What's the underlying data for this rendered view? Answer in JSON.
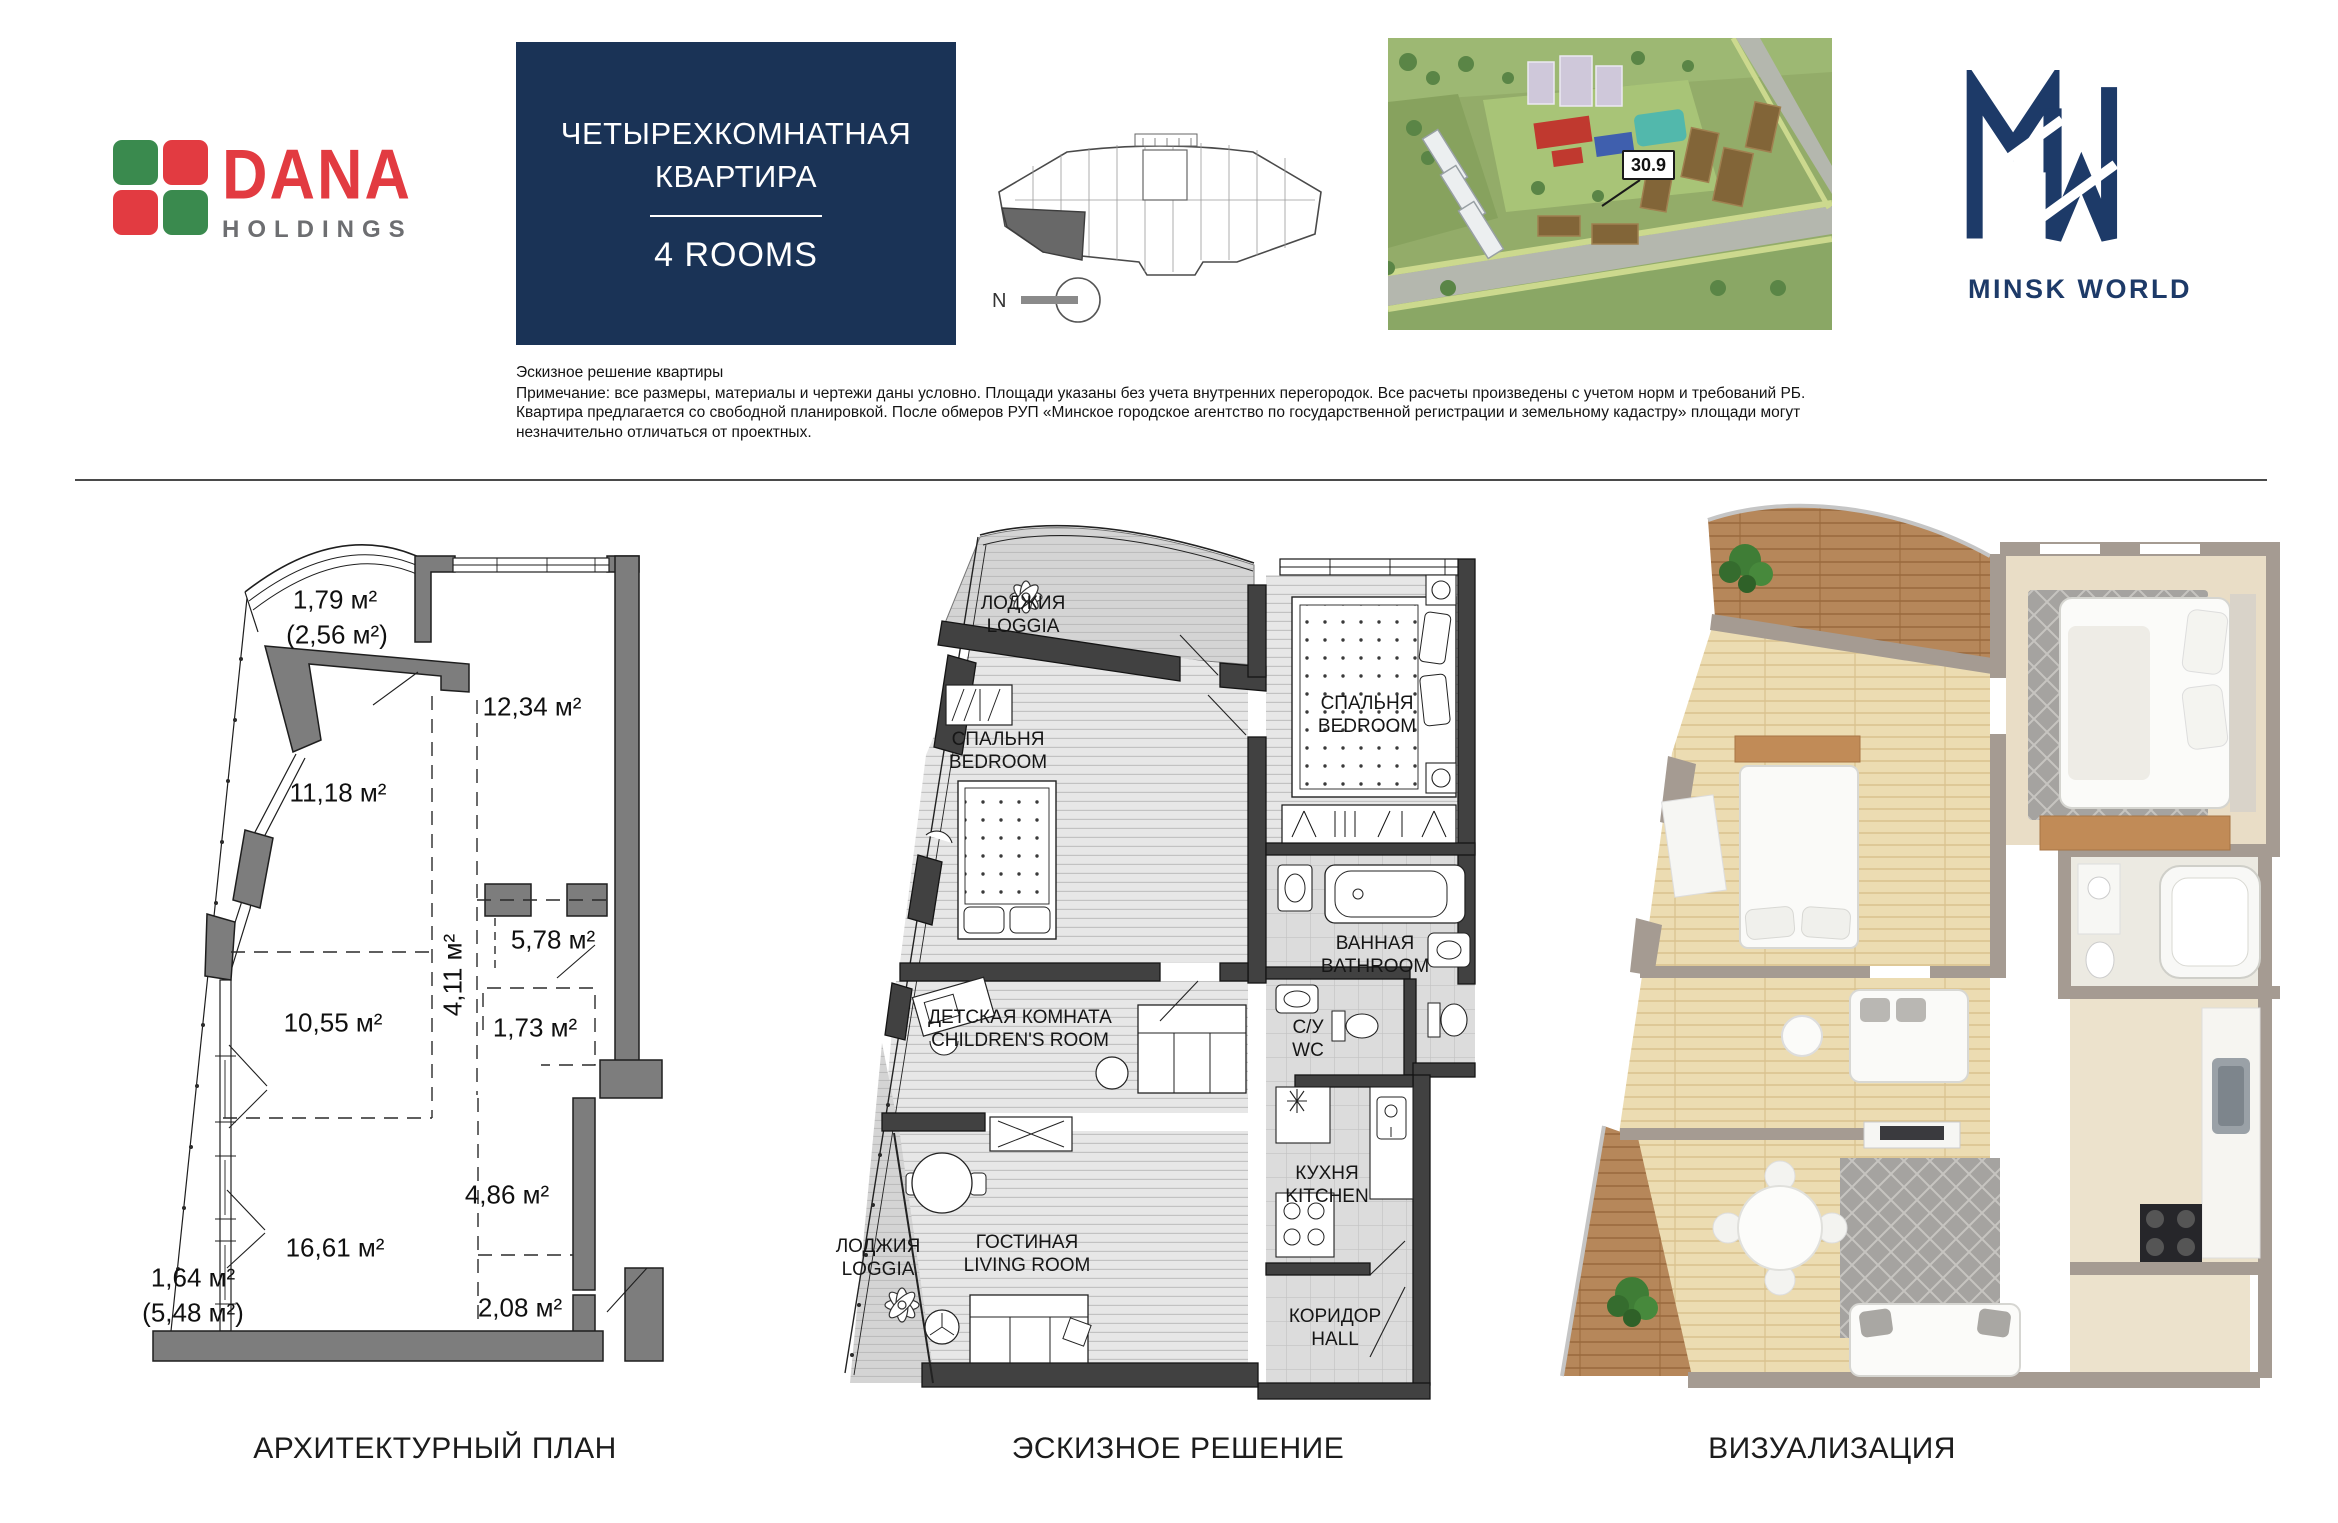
{
  "header": {
    "dana": {
      "name": "DANA",
      "subname": "HOLDINGS"
    },
    "title_block": {
      "line1": "ЧЕТЫРЕХКОМНАТНАЯ",
      "line2": "КВАРТИРА",
      "rooms_label": "4 ROOMS"
    },
    "key_plan": {
      "north_label": "N"
    },
    "site_map": {
      "building_number": "30.9"
    },
    "brand": {
      "name": "MINSK WORLD"
    }
  },
  "disclaimer": {
    "title": "Эскизное решение квартиры",
    "note": "Примечание: все размеры, материалы и чертежи даны условно. Площади указаны без учета внутренних перегородок. Все расчеты произведены с учетом норм и требований РБ. Квартира предлагается со свободной планировкой. После обмеров РУП «Минское городское агентство по государственной регистрации и земельному кадастру» площади могут незначительно отличаться от проектных."
  },
  "architectural_plan": {
    "caption": "АРХИТЕКТУРНЫЙ ПЛАН",
    "areas": {
      "balcony": {
        "label": "1,79 м²",
        "total": "(2,56 м²)"
      },
      "room_top_right": "12,34 м²",
      "room_upper_left": "11,18 м²",
      "kitchen_zone": "5,78 м²",
      "corridor": "4,11 м²",
      "storage": "1,73 м²",
      "room_middle_left": "10,55 м²",
      "hall": "4,86 м²",
      "room_lower_left": "16,61 м²",
      "loggia": {
        "label": "1,64 м²",
        "total": "(5,48 м²)"
      },
      "entry": "2,08 м²"
    }
  },
  "sketch_plan": {
    "caption": "ЭСКИЗНОЕ РЕШЕНИЕ",
    "rooms": {
      "loggia_top": {
        "ru": "ЛОДЖИЯ",
        "en": "LOGGIA"
      },
      "bedroom_left": {
        "ru": "СПАЛЬНЯ",
        "en": "BEDROOM"
      },
      "bedroom_right": {
        "ru": "СПАЛЬНЯ",
        "en": "BEDROOM"
      },
      "bathroom": {
        "ru": "ВАННАЯ",
        "en": "BATHROOM"
      },
      "children_room": {
        "ru": "ДЕТСКАЯ КОМНАТА",
        "en": "CHILDREN'S ROOM"
      },
      "wc": {
        "ru": "С/У",
        "en": "WC"
      },
      "kitchen": {
        "ru": "КУХНЯ",
        "en": "KITCHEN"
      },
      "living_room": {
        "ru": "ГОСТИНАЯ",
        "en": "LIVING ROOM"
      },
      "loggia_bottom": {
        "ru": "ЛОДЖИЯ",
        "en": "LOGGIA"
      },
      "hall": {
        "ru": "КОРИДОР",
        "en": "HALL"
      }
    }
  },
  "visualization": {
    "caption": "ВИЗУАЛИЗАЦИЯ"
  },
  "colors": {
    "accent_navy": "#1a3356",
    "brand_navy": "#1d3a68",
    "dana_red": "#e23b41",
    "dana_green": "#3a8a4e"
  }
}
